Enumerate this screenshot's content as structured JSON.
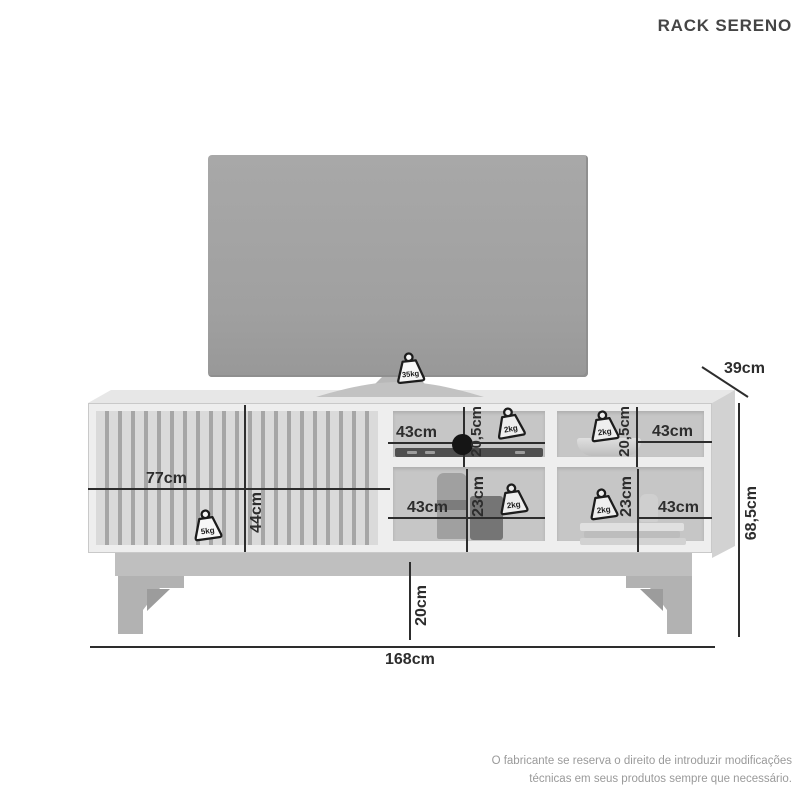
{
  "title": "RACK SERENO",
  "product": {
    "overall": {
      "width": "168cm",
      "height": "68,5cm",
      "depth": "39cm",
      "base_height": "20cm"
    },
    "tv_max_weight": "35kg",
    "drawer": {
      "width": "77cm",
      "height": "44cm",
      "max_weight": "5kg"
    },
    "shelves": {
      "top_left": {
        "width": "43cm",
        "height": "20,5cm",
        "max_weight": "2kg"
      },
      "top_right": {
        "width": "43cm",
        "height": "20,5cm",
        "max_weight": "2kg"
      },
      "bottom_left": {
        "width": "43cm",
        "height": "23cm",
        "max_weight": "2kg"
      },
      "bottom_right": {
        "width": "43cm",
        "height": "23cm",
        "max_weight": "2kg"
      }
    }
  },
  "icons": {
    "weight": "weight-kettlebell-icon"
  },
  "footer": {
    "disclaimer_line1": "O fabricante se reserva o direito de introduzir modificações",
    "disclaimer_line2": "técnicas em seus produtos sempre que necessário."
  },
  "colors": {
    "background": "#ffffff",
    "dimension_line": "#2d2d2d",
    "label_text": "#2d2d2d",
    "title_text": "#454545",
    "disclaimer_text": "#9a9a9a",
    "tv_screen": "#a2a2a2",
    "rack_frame": "#eeeeee",
    "compartment_back": "#c6c6c6",
    "slat_groove": "#a6a6a6"
  }
}
